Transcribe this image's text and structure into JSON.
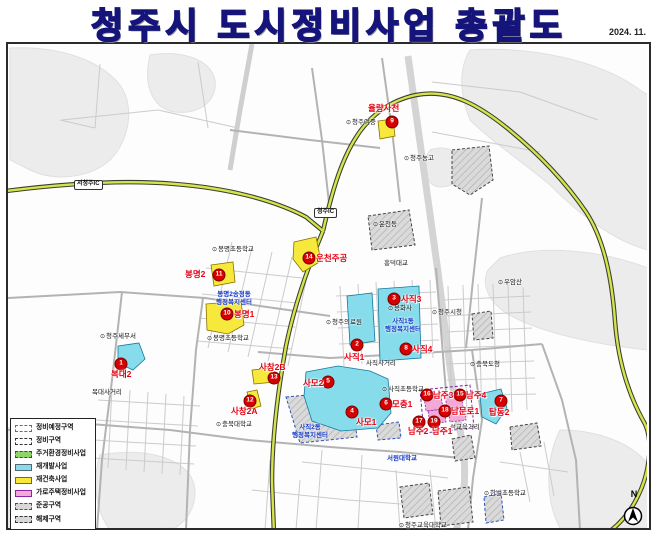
{
  "title": "청주시 도시정비사업 총괄도",
  "date": "2024. 11.",
  "north_label": "N",
  "legend": {
    "items": [
      {
        "label": "정비예정구역",
        "type": "plan"
      },
      {
        "label": "정비구역",
        "type": "zone"
      },
      {
        "label": "주거환경정비사업",
        "type": "resid"
      },
      {
        "label": "재개발사업",
        "type": "redevelop"
      },
      {
        "label": "재건축사업",
        "type": "rebuild"
      },
      {
        "label": "가로주택정비사업",
        "type": "street"
      },
      {
        "label": "준공구역",
        "type": "done"
      },
      {
        "label": "해제구역",
        "type": "cancel"
      }
    ]
  },
  "zones": [
    {
      "num": 1,
      "name": "복대2",
      "type": "redevelop",
      "m": [
        121,
        364
      ],
      "l": [
        111,
        370
      ]
    },
    {
      "num": 2,
      "name": "사직1",
      "type": "redevelop",
      "m": [
        357,
        345
      ],
      "l": [
        344,
        353
      ]
    },
    {
      "num": 3,
      "name": "사직3",
      "type": "redevelop",
      "m": [
        394,
        299
      ],
      "l": [
        401,
        295
      ]
    },
    {
      "num": 4,
      "name": "사모1",
      "type": "redevelop",
      "m": [
        352,
        412
      ],
      "l": [
        356,
        418
      ]
    },
    {
      "num": 5,
      "name": "사모2",
      "type": "redevelop",
      "m": [
        328,
        382
      ],
      "l": [
        303,
        379
      ]
    },
    {
      "num": 6,
      "name": "모충1",
      "type": "redevelop",
      "m": [
        386,
        404
      ],
      "l": [
        392,
        400
      ]
    },
    {
      "num": 7,
      "name": "탑동2",
      "type": "redevelop",
      "m": [
        501,
        401
      ],
      "l": [
        489,
        408
      ]
    },
    {
      "num": 8,
      "name": "사직4",
      "type": "redevelop",
      "m": [
        406,
        349
      ],
      "l": [
        412,
        345
      ]
    },
    {
      "num": 9,
      "name": "율량사천",
      "type": "rebuild",
      "m": [
        392,
        122
      ],
      "l": [
        368,
        104
      ]
    },
    {
      "num": 10,
      "name": "봉명1",
      "type": "rebuild",
      "m": [
        227,
        314
      ],
      "l": [
        234,
        310
      ]
    },
    {
      "num": 11,
      "name": "봉명2",
      "type": "rebuild",
      "m": [
        219,
        275
      ],
      "l": [
        185,
        270
      ]
    },
    {
      "num": 12,
      "name": "사창2A",
      "type": "rebuild",
      "m": [
        250,
        401
      ],
      "l": [
        231,
        407
      ]
    },
    {
      "num": 13,
      "name": "사창2B",
      "type": "rebuild",
      "m": [
        274,
        378
      ],
      "l": [
        259,
        363
      ]
    },
    {
      "num": 14,
      "name": "운천주공",
      "type": "rebuild",
      "m": [
        309,
        258
      ],
      "l": [
        316,
        254
      ]
    },
    {
      "num": 15,
      "name": "남주4",
      "type": "street",
      "m": [
        460,
        395
      ],
      "l": [
        466,
        391
      ]
    },
    {
      "num": 16,
      "name": "남주3",
      "type": "street",
      "m": [
        427,
        395
      ],
      "l": [
        433,
        391
      ]
    },
    {
      "num": 17,
      "name": "남주2",
      "type": "street",
      "m": [
        419,
        422
      ],
      "l": [
        408,
        427
      ]
    },
    {
      "num": 18,
      "name": "남문로1",
      "type": "street",
      "m": [
        445,
        411
      ],
      "l": [
        451,
        407
      ]
    },
    {
      "num": 19,
      "name": "남주1",
      "type": "street",
      "m": [
        434,
        422
      ],
      "l": [
        432,
        427
      ]
    }
  ],
  "pois": [
    {
      "text": "봉명초등학교",
      "x": 212,
      "y": 247,
      "icon": true
    },
    {
      "text": "봉명초등학교",
      "x": 207,
      "y": 336,
      "icon": true
    },
    {
      "text": "청주여중",
      "x": 346,
      "y": 120,
      "icon": true
    },
    {
      "text": "청주농고",
      "x": 404,
      "y": 156,
      "icon": true
    },
    {
      "text": "용화사",
      "x": 388,
      "y": 306,
      "icon": true
    },
    {
      "text": "청주의료원",
      "x": 326,
      "y": 320,
      "icon": true
    },
    {
      "text": "충북대학교",
      "x": 216,
      "y": 422,
      "icon": true
    },
    {
      "text": "청주교육대학교",
      "x": 399,
      "y": 523,
      "icon": true
    },
    {
      "text": "우암산",
      "x": 498,
      "y": 280,
      "icon": true
    },
    {
      "text": "청주시청",
      "x": 432,
      "y": 310,
      "icon": true
    },
    {
      "text": "충북도청",
      "x": 470,
      "y": 362,
      "icon": true
    },
    {
      "text": "청주세무서",
      "x": 100,
      "y": 334,
      "icon": true
    },
    {
      "text": "운천동",
      "x": 373,
      "y": 222,
      "icon": true
    },
    {
      "text": "사직초등학교",
      "x": 382,
      "y": 387,
      "icon": true
    },
    {
      "text": "한벌초등학교",
      "x": 484,
      "y": 491,
      "icon": true
    },
    {
      "text": "복대사거리",
      "x": 92,
      "y": 390,
      "icon": false
    },
    {
      "text": "사직사거리",
      "x": 366,
      "y": 361,
      "icon": false
    },
    {
      "text": "석교육거리",
      "x": 450,
      "y": 425,
      "icon": false
    },
    {
      "text": "흥덕대교",
      "x": 384,
      "y": 261,
      "icon": false
    }
  ],
  "offices": [
    {
      "lines": [
        "봉명2송정동",
        "행정복지센터"
      ],
      "x": 234,
      "y": 291
    },
    {
      "lines": [
        "사직1동",
        "행정복지센터"
      ],
      "x": 403,
      "y": 318
    },
    {
      "lines": [
        "사직2동",
        "행정복지센터"
      ],
      "x": 310,
      "y": 424
    },
    {
      "lines": [
        "서원대학교"
      ],
      "x": 402,
      "y": 455
    }
  ],
  "road_labels": [
    {
      "text": "서청주IC",
      "x": 74,
      "y": 180
    },
    {
      "text": "청주IC",
      "x": 314,
      "y": 208
    }
  ]
}
